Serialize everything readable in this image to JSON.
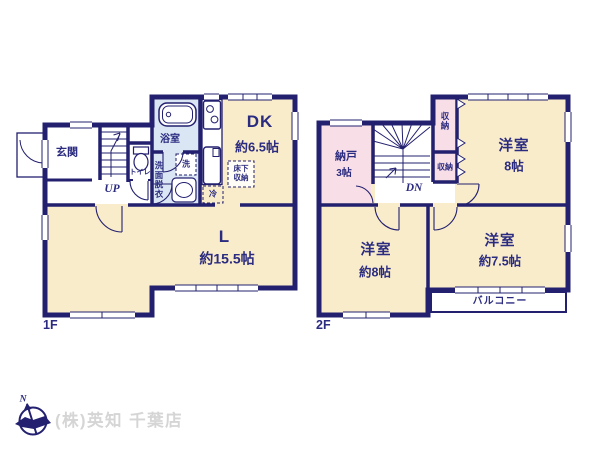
{
  "colors": {
    "wall": "#23206f",
    "room_cream": "#f9ecca",
    "room_pink": "#f8dee7",
    "room_blue": "#dbe6f4",
    "balcony_white": "#ffffff",
    "label_navy": "#2b2b80",
    "watermark_gray": "#d5d5d5"
  },
  "floor1": {
    "label": "1F",
    "entrance": "玄関",
    "bathroom": "浴室",
    "toilet": "トイレ",
    "washroom": "洗面脱衣",
    "washer": "洗",
    "dining_kitchen": "DK",
    "dining_kitchen_size": "約6.5帖",
    "underfloor_storage": "床下収納",
    "fridge": "冷",
    "living": "L",
    "living_size": "約15.5帖",
    "stairs": "UP"
  },
  "floor2": {
    "label": "2F",
    "storage_room": "納戸",
    "storage_room_size": "3帖",
    "closet_upper": "収納",
    "closet_lower": "収納",
    "bedroom_ne": {
      "name": "洋室",
      "size": "8帖"
    },
    "bedroom_sw": {
      "name": "洋室",
      "size": "約8帖"
    },
    "bedroom_se": {
      "name": "洋室",
      "size": "約7.5帖"
    },
    "balcony": "バルコニー",
    "stairs": "DN"
  },
  "footer": {
    "compass_north": "N",
    "company": "(株)英知 千葉店"
  }
}
